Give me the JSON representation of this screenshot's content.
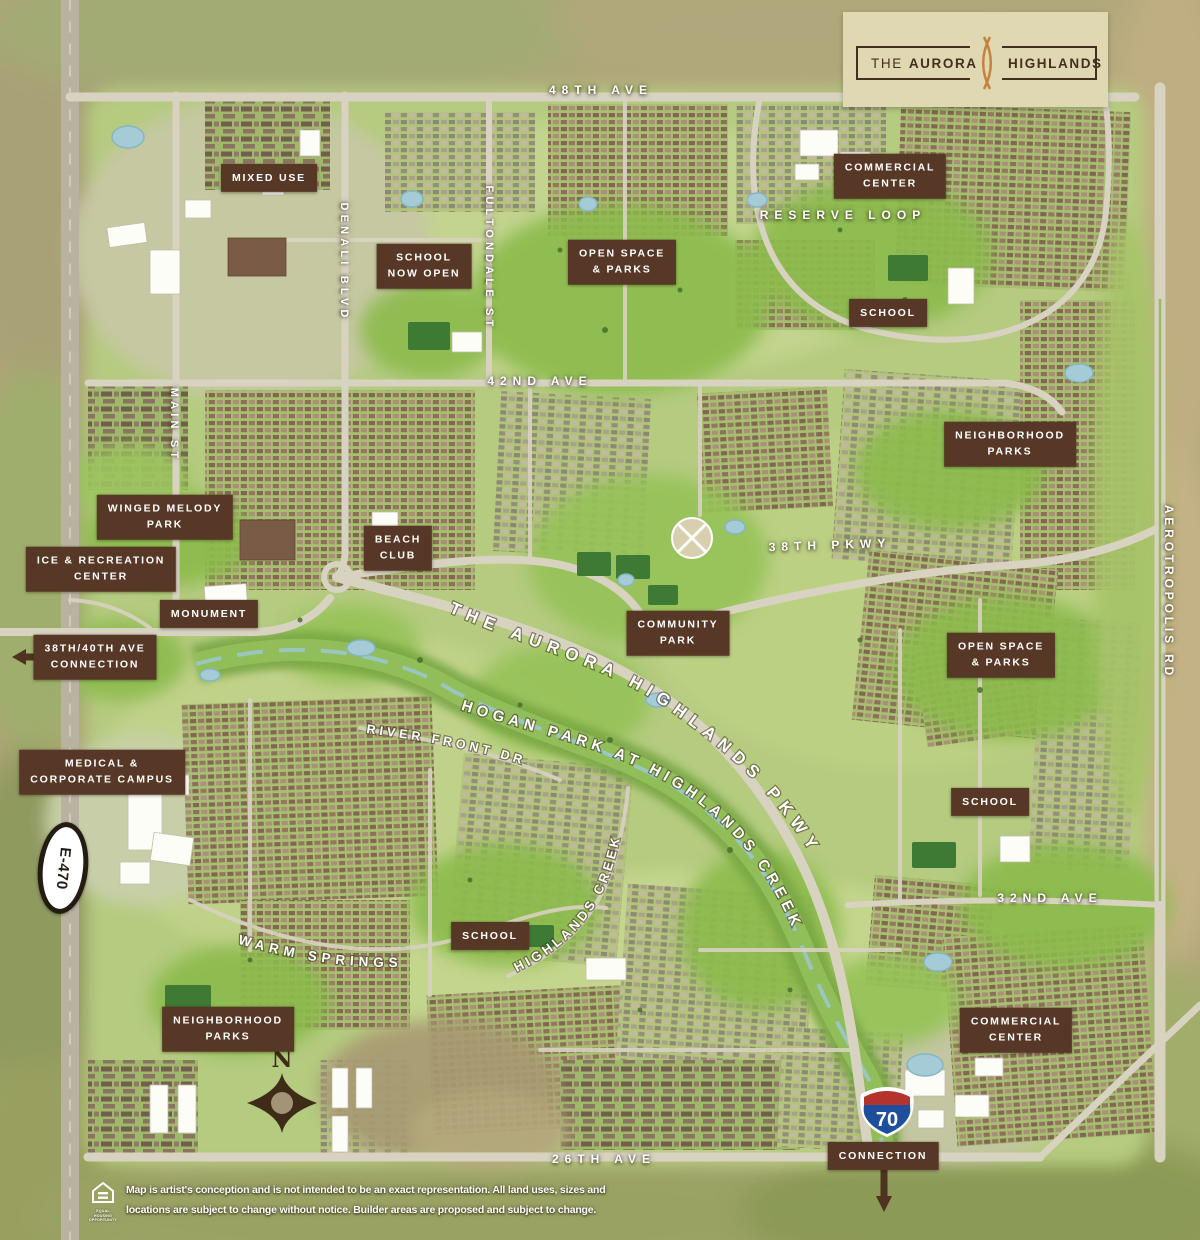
{
  "logo": {
    "title_left_thin": "THE",
    "title_left_bold": "AURORA",
    "title_right": "HIGHLANDS"
  },
  "streets": {
    "ave48": "48TH AVE",
    "ave42": "42ND AVE",
    "ave32": "32ND AVE",
    "ave26": "26TH AVE",
    "pkwy38": "38TH PKWY",
    "reserve_loop": "RESERVE LOOP",
    "main_st": "MAIN ST",
    "denali_blvd": "DENALI BLVD",
    "fultondale_st": "FULTONDALE ST",
    "aerotropolis_rd": "AEROTROPOLIS RD",
    "warm_springs": "WARM SPRINGS",
    "river_front_dr": "RIVER FRONT DR",
    "aurora_highlands_pkwy": "THE AURORA HIGHLANDS PKWY",
    "hogan_park": "HOGAN PARK AT HIGHLANDS CREEK",
    "highlands_creek": "HIGHLANDS CREEK"
  },
  "labels": [
    {
      "id": "mixed-use",
      "text": "MIXED USE"
    },
    {
      "id": "school-now-open",
      "text": "SCHOOL\nNOW OPEN"
    },
    {
      "id": "open-space-parks-north",
      "text": "OPEN SPACE\n& PARKS"
    },
    {
      "id": "commercial-center-north",
      "text": "COMMERCIAL\nCENTER"
    },
    {
      "id": "school-northeast",
      "text": "SCHOOL"
    },
    {
      "id": "neighborhood-parks-east",
      "text": "NEIGHBORHOOD\nPARKS"
    },
    {
      "id": "winged-melody-park",
      "text": "WINGED MELODY\nPARK"
    },
    {
      "id": "ice-recreation-center",
      "text": "ICE & RECREATION\nCENTER"
    },
    {
      "id": "beach-club",
      "text": "BEACH\nCLUB"
    },
    {
      "id": "monument",
      "text": "MONUMENT"
    },
    {
      "id": "connection-38-40",
      "text": "38TH/40TH AVE\nCONNECTION"
    },
    {
      "id": "community-park",
      "text": "COMMUNITY\nPARK"
    },
    {
      "id": "open-space-parks-east",
      "text": "OPEN SPACE\n& PARKS"
    },
    {
      "id": "medical-corporate-campus",
      "text": "MEDICAL &\nCORPORATE CAMPUS"
    },
    {
      "id": "school-east",
      "text": "SCHOOL"
    },
    {
      "id": "school-southwest",
      "text": "SCHOOL"
    },
    {
      "id": "neighborhood-parks-southwest",
      "text": "NEIGHBORHOOD\nPARKS"
    },
    {
      "id": "commercial-center-south",
      "text": "COMMERCIAL\nCENTER"
    },
    {
      "id": "connection-i70",
      "text": "CONNECTION"
    }
  ],
  "badges": {
    "interstate": "70",
    "tollway": "E-470",
    "compass_north": "N"
  },
  "footer": {
    "disclaimer_line1": "Map is artist's conception and is not intended to be an exact representation. All land uses, sizes and",
    "disclaimer_line2": "locations are subject to change without notice. Builder areas are proposed and subject to change.",
    "eho_line1": "EQUAL HOUSING",
    "eho_line2": "OPPORTUNITY"
  },
  "colors": {
    "label_bg": "#573826",
    "logo_cream": "#e0d8b2",
    "logo_brown": "#42301e",
    "accent_orange": "#c5823f",
    "interstate_red": "#b5332d",
    "interstate_blue": "#1d4f9c",
    "road": "#d8d2c1"
  }
}
